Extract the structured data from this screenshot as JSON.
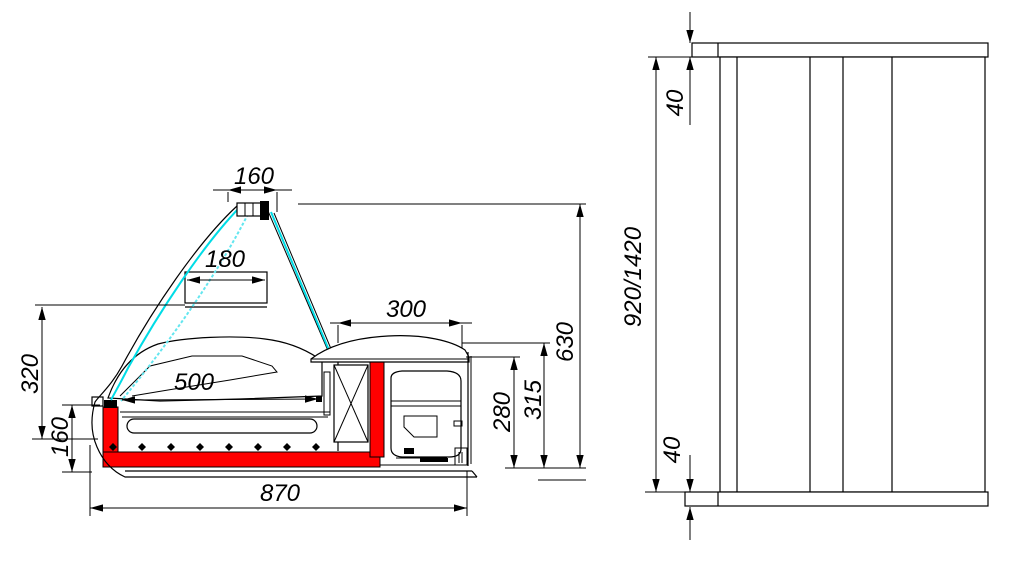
{
  "drawing": {
    "kind": "technical dimension drawing",
    "views": [
      "side-section-view",
      "front-view"
    ],
    "colors": {
      "line": "#000000",
      "bumper_red": "#ff0000",
      "glass_cyan": "#00dce6",
      "background": "#ffffff"
    }
  },
  "dims": {
    "side": {
      "lamp_width": "160",
      "shelf_width": "180",
      "display_length": "500",
      "bay_width": "300",
      "glass_height": "320",
      "base_height": "160",
      "total_depth": "870",
      "bay_inner_height": "280",
      "bay_height": "315",
      "total_height": "630"
    },
    "front": {
      "top_thickness": "40",
      "length": "920/1420",
      "bottom_thickness": "40"
    }
  }
}
